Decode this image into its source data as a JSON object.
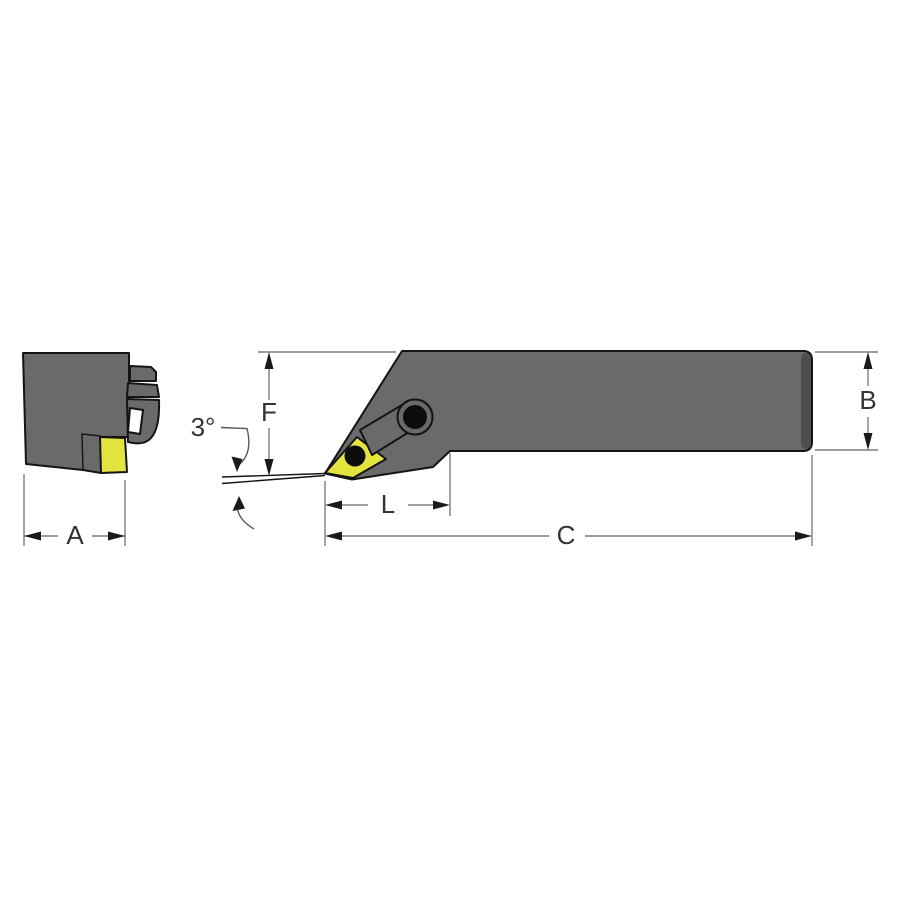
{
  "drawing": {
    "type": "technical-dimension-drawing",
    "subject": "lathe turning tool holder with diamond carbide insert, end view and side view",
    "labels": {
      "shank_width": "A",
      "shank_height": "B",
      "overall_length": "C",
      "head_height": "F",
      "head_length": "L",
      "angle": "3°"
    }
  },
  "colors": {
    "body_gray": "#6a6a6a",
    "edge_shade": "#4e4e4e",
    "insert_yellow": "#e3e43e",
    "outline": "#141414",
    "dimension_gray": "#7d7d7d",
    "arrow_black": "#1a1a1a",
    "text": "#333333",
    "background": "#ffffff",
    "slot_white": "#ffffff",
    "hole_black": "#0d0d0d"
  }
}
